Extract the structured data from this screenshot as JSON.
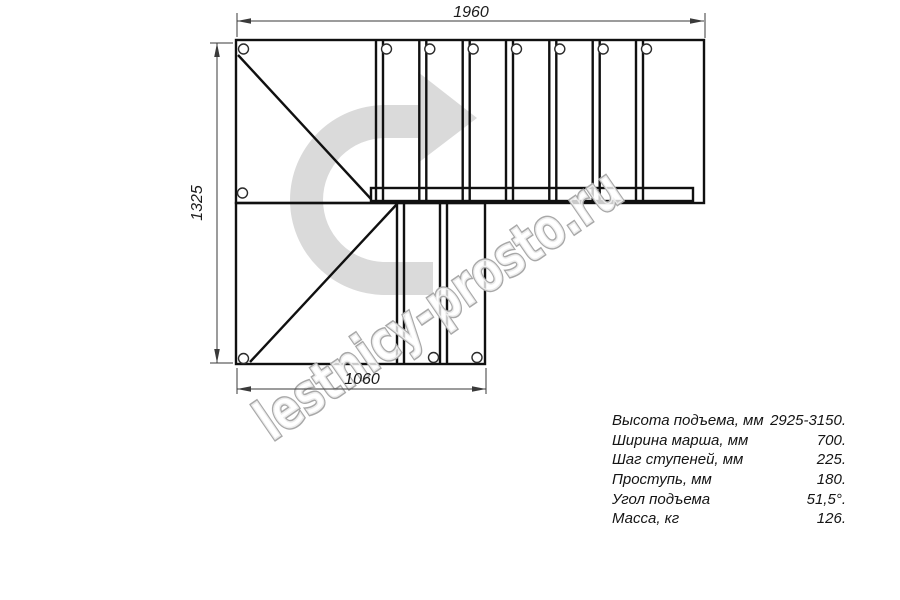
{
  "drawing": {
    "type": "staircase-plan-top-view",
    "watermark": "lestnicy-prosto.ru",
    "dimensions": {
      "top_width_mm": "1960",
      "left_height_mm": "1325",
      "bottom_width_mm": "1060"
    },
    "icons": {
      "direction_arrow": "u-turn-right-direction-arrow"
    },
    "colors": {
      "outline": "#101010",
      "dimension": "#3a3a3a",
      "direction_arrow_fill": "#dadada",
      "watermark_stroke": "#a8a8a8",
      "background": "#ffffff"
    }
  },
  "specs": {
    "rows": [
      {
        "label": "Высота подъема, мм",
        "value": "2925-3150."
      },
      {
        "label": "Ширина марша, мм",
        "value": "700."
      },
      {
        "label": "Шаг ступеней, мм",
        "value": "225."
      },
      {
        "label": "Проступь, мм",
        "value": "180."
      },
      {
        "label": "Угол подъема",
        "value": "51,5°."
      },
      {
        "label": "Масса, кг",
        "value": "126."
      }
    ]
  }
}
